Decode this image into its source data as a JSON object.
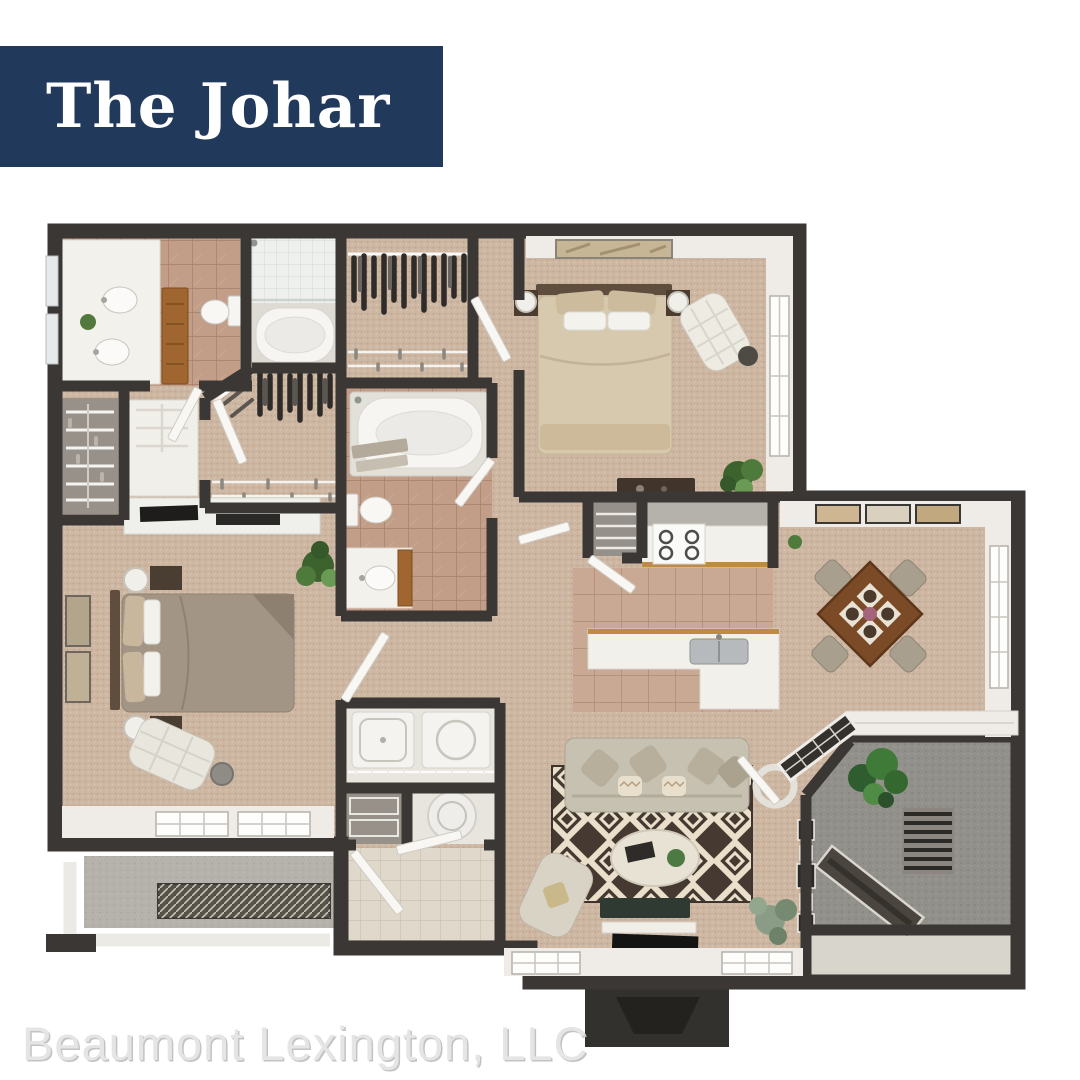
{
  "banner": {
    "title": "The Johar"
  },
  "footer": {
    "company": "Beaumont Lexington, LLC"
  },
  "colors": {
    "banner-bg": "#21395b",
    "banner-text": "#ffffff",
    "footer-text": "#e5e5e5",
    "footer-shadow": "#c3c3c3",
    "wall": "#3a3734",
    "carpet": "#cdb7a3",
    "bath-tile": "#c29e88",
    "kitchen-tile": "#c9a993",
    "concrete": "#92908a",
    "cabinet-wood": "#a0662f",
    "rug-dark": "#463931",
    "rug-cream": "#eadfca"
  }
}
